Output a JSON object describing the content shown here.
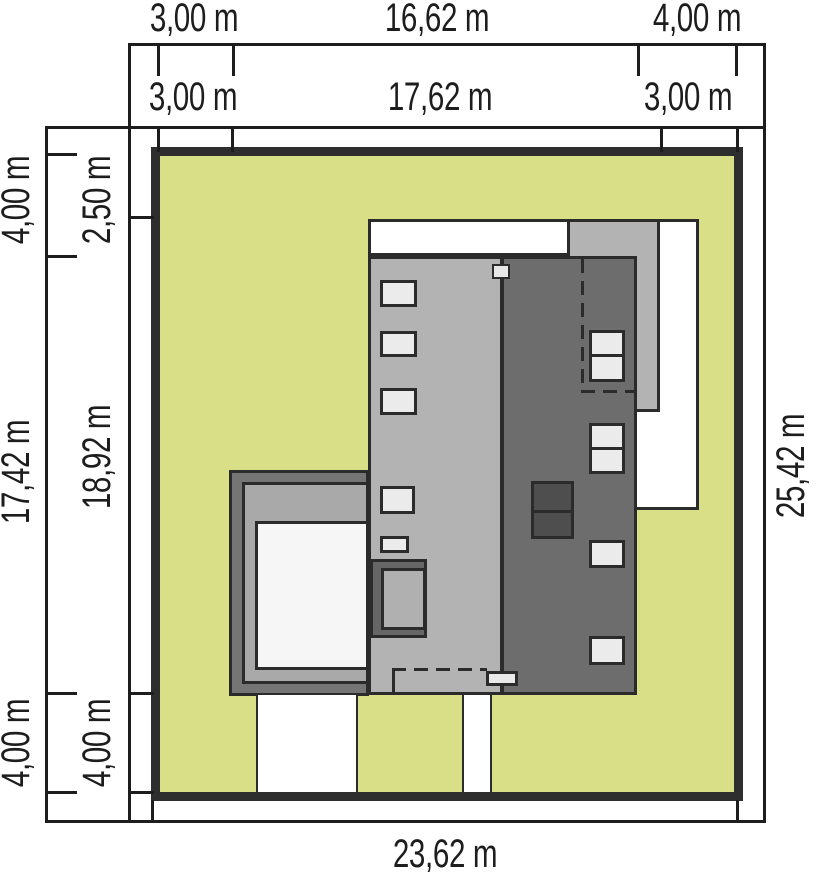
{
  "dims": {
    "top_outer": [
      "3,00 m",
      "16,62 m",
      "4,00 m"
    ],
    "top_inner": [
      "3,00 m",
      "17,62 m",
      "3,00 m"
    ],
    "left_outer": [
      "4,00 m",
      "17,42 m",
      "4,00 m"
    ],
    "left_inner": [
      "2,50 m",
      "18,92 m",
      "4,00 m"
    ],
    "right": "25,42 m",
    "bottom": "23,62 m"
  },
  "colors": {
    "plot_green": "#d9df87",
    "plot_border": "#2e2e2e",
    "line": "#1d1d1d",
    "stroke": "#2b2b2b",
    "roof_light": "#b3b3b3",
    "roof_dark": "#6d6d6d",
    "window": "#ebebeb",
    "chimney_dark": "#4e4e4e",
    "terrace_frame": "#757575",
    "terrace_mid": "#a9a9a9",
    "terrace_floor": "#f6f6f6",
    "entry_frame": "#666666",
    "entry_inner": "#b0b0b0"
  }
}
